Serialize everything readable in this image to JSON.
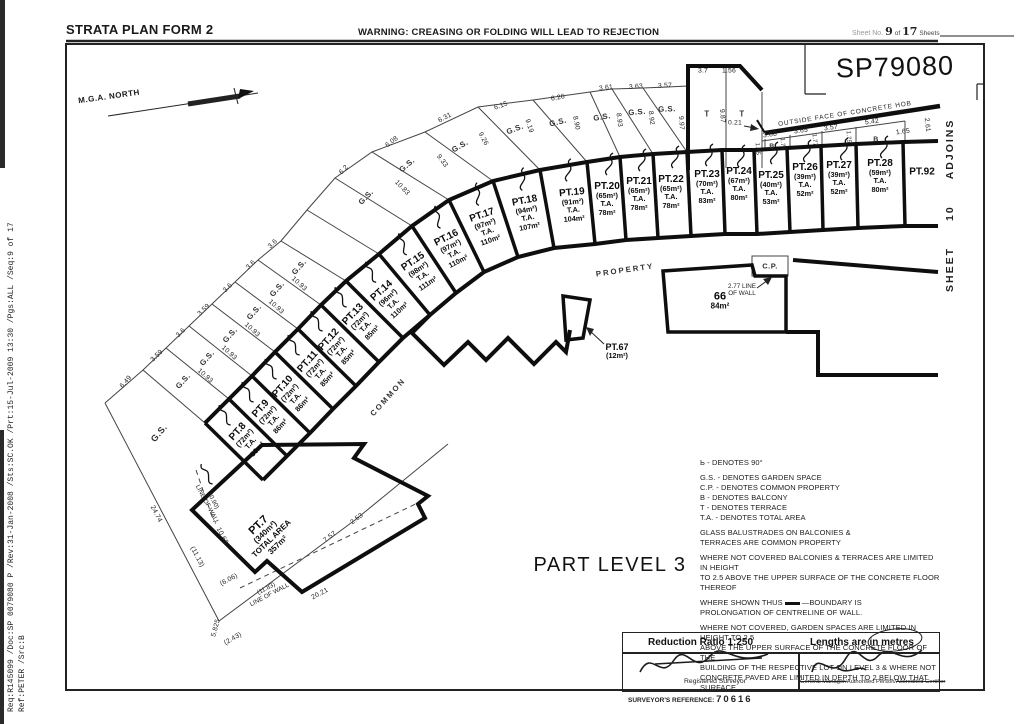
{
  "header": {
    "title": "STRATA PLAN FORM 2",
    "warning": "WARNING: CREASING OR FOLDING WILL LEAD TO REJECTION",
    "sheet_label": "Sheet No.",
    "sheet_no": "9",
    "sheet_of": "of",
    "sheet_total": "17",
    "sheet_word": "Sheets"
  },
  "sidemeta": {
    "line1": "Req:R145099 /Doc:SP 0079080 P /Rev:31-Jan-2008 /Sts:SC.OK /Prt:15-Jul-2009 13:30 /Pgs:ALL /Seq:9 of 17",
    "line2": "Ref:PETER /Src:B"
  },
  "plan": {
    "plan_no": "SP79080",
    "part_level": "PART LEVEL 3",
    "north_label": "M.G.A. NORTH",
    "adjoins_sheet": "SHEET",
    "adjoins_num": "10",
    "adjoins_word": "ADJOINS",
    "hob_label": "OUTSIDE FACE OF CONCRETE HOB",
    "common_label": "COMMON",
    "property_label": "PROPERTY",
    "gs": "G.S.",
    "cp": "C.P.",
    "b": "B",
    "t": "T",
    "lots": [
      {
        "id": "PT.7",
        "l2": "(340m²)",
        "l3": "TOTAL AREA",
        "l4": "357m²"
      },
      {
        "id": "PT.8",
        "l2": "(72m²)",
        "l3": "T.A.",
        "l4": "86m²"
      },
      {
        "id": "PT.9",
        "l2": "(72m²)",
        "l3": "T.A.",
        "l4": "86m²"
      },
      {
        "id": "PT.10",
        "l2": "(72m²)",
        "l3": "T.A.",
        "l4": "86m²"
      },
      {
        "id": "PT.11",
        "l2": "(72m²)",
        "l3": "T.A.",
        "l4": "85m²"
      },
      {
        "id": "PT.12",
        "l2": "(72m²)",
        "l3": "T.A.",
        "l4": "85m²"
      },
      {
        "id": "PT.13",
        "l2": "(72m²)",
        "l3": "T.A.",
        "l4": "85m²"
      },
      {
        "id": "PT.14",
        "l2": "(96m²)",
        "l3": "T.A.",
        "l4": "110m²"
      },
      {
        "id": "PT.15",
        "l2": "(98m²)",
        "l3": "T.A.",
        "l4": "111m²"
      },
      {
        "id": "PT.16",
        "l2": "(97m²)",
        "l3": "T.A.",
        "l4": "110m²"
      },
      {
        "id": "PT.17",
        "l2": "(97m²)",
        "l3": "T.A.",
        "l4": "110m²"
      },
      {
        "id": "PT.18",
        "l2": "(94m²)",
        "l3": "T.A.",
        "l4": "107m²"
      },
      {
        "id": "PT.19",
        "l2": "(91m²)",
        "l3": "T.A.",
        "l4": "104m²"
      },
      {
        "id": "PT.20",
        "l2": "(65m²)",
        "l3": "T.A.",
        "l4": "78m²"
      },
      {
        "id": "PT.21",
        "l2": "(65m²)",
        "l3": "T.A.",
        "l4": "78m²"
      },
      {
        "id": "PT.22",
        "l2": "(65m²)",
        "l3": "T.A.",
        "l4": "78m²"
      },
      {
        "id": "PT.23",
        "l2": "(70m²)",
        "l3": "T.A.",
        "l4": "83m²"
      },
      {
        "id": "PT.24",
        "l2": "(67m²)",
        "l3": "T.A.",
        "l4": "80m²"
      },
      {
        "id": "PT.25",
        "l2": "(40m²)",
        "l3": "T.A.",
        "l4": "53m²"
      },
      {
        "id": "PT.26",
        "l2": "(39m²)",
        "l3": "T.A.",
        "l4": "52m²"
      },
      {
        "id": "PT.27",
        "l2": "(39m²)",
        "l3": "T.A.",
        "l4": "52m²"
      },
      {
        "id": "PT.28",
        "l2": "(59m²)",
        "l3": "T.A.",
        "l4": "80m²"
      },
      {
        "id": "PT.92"
      },
      {
        "id": "66",
        "l2": "84m²"
      },
      {
        "id": "PT.67",
        "l2": "(12m²)"
      }
    ],
    "m": [
      "6.49",
      "3.59",
      "3.6",
      "3.59",
      "3.6",
      "3.6",
      "3.6",
      "6.2",
      "6.08",
      "6.31",
      "6.15",
      "6.26",
      "3.61",
      "3.63",
      "3.57",
      "3.7",
      "1.56",
      "0.21",
      "3.68",
      "3.65",
      "3.57",
      "5.42",
      "1.65",
      "2.61",
      "10.93",
      "10.93",
      "10.93",
      "10.93",
      "10.93",
      "10.83",
      "9.33",
      "9.26",
      "9.19",
      "8.90",
      "8.93",
      "8.92",
      "9.97",
      "9.87",
      "1.75",
      "1.73",
      "1.77",
      "1.75",
      "24.74",
      "10.68",
      "(11.13)",
      "(6.06)",
      "5.825",
      "(2.43)",
      "20.21",
      "7.57",
      "2.53"
    ],
    "low1": {
      "l1": "(0.90)",
      "l2": "LINE OF WALL"
    },
    "low2": {
      "l1": "(11.83)",
      "l2": "LINE OF WALL"
    },
    "wall66": {
      "l1": "2.77 LINE",
      "l2": "OF WALL"
    }
  },
  "legend": {
    "angle_icon": "Ь",
    "angle_text": "- DENOTES 90°",
    "d1": "G.S. - DENOTES GARDEN SPACE",
    "d2": "C.P. - DENOTES COMMON PROPERTY",
    "d3": "B - DENOTES BALCONY",
    "d4": "T - DENOTES TERRACE",
    "d5": "T.A. - DENOTES TOTAL AREA",
    "p1a": "GLASS BALUSTRADES ON BALCONIES &",
    "p1b": "TERRACES ARE COMMON PROPERTY",
    "p2a": "WHERE NOT COVERED BALCONIES & TERRACES ARE LIMITED IN HEIGHT",
    "p2b": "TO 2.5 ABOVE THE UPPER SURFACE OF THE CONCRETE FLOOR THEREOF",
    "p3a": "WHERE SHOWN THUS",
    "p3b": "—BOUNDARY IS",
    "p3c": "PROLONGATION OF CENTRELINE OF WALL.",
    "p4a": "WHERE NOT COVERED, GARDEN SPACES ARE LIMITED IN HEIGHT TO 2.5",
    "p4b": "ABOVE THE UPPER SURFACE OF THE CONCRETE FLOOR OF THE",
    "p4c": "BUILDING OF THE RESPECTIVE LOT ON LEVEL 3 & WHERE NOT",
    "p4d": "CONCRETE PAVED ARE LIMITED IN DEPTH TO 2 BELOW THAT SURFACE."
  },
  "footer": {
    "reduction": "Reduction Ratio 1:250",
    "lengths": "Lengths are in metres",
    "registered_surveyor": "Registered Surveyor",
    "cert_struck1": "General Manager/",
    "cert_kept": "Authorised Person/",
    "cert_struck2": "Accredited Certifier",
    "ref_label": "SURVEYOR'S REFERENCE:",
    "ref_value": "70616"
  }
}
